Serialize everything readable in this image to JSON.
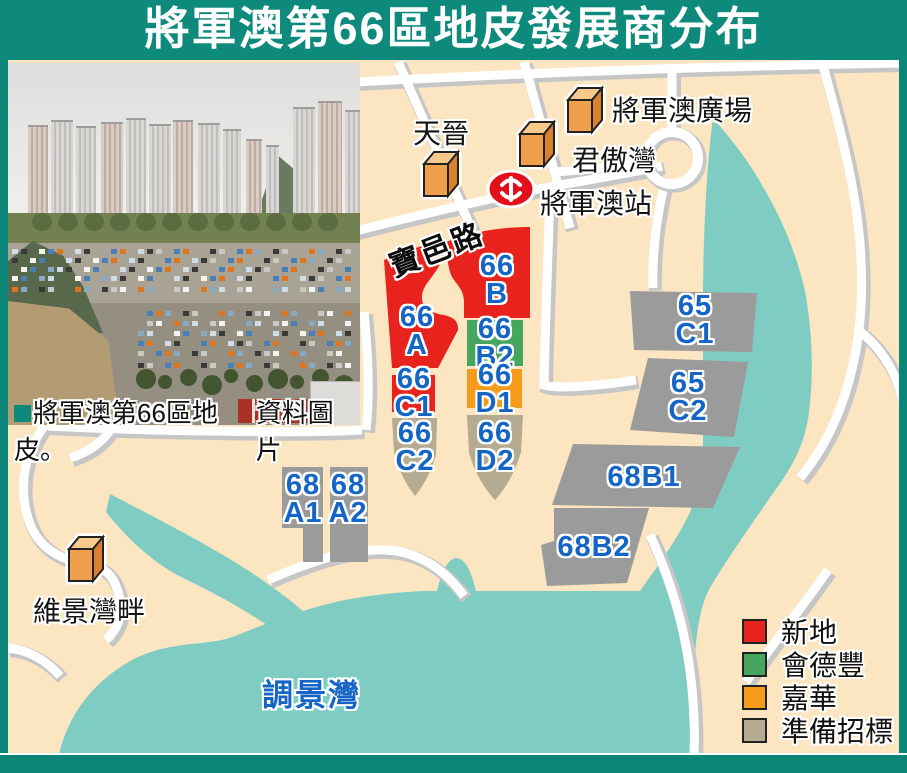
{
  "title": "將軍澳第66區地皮發展商分布",
  "photo": {
    "caption": "將軍澳第66區地皮。",
    "credit": "資料圖片"
  },
  "map": {
    "road_label": "寶邑路",
    "water_label": "調景灣",
    "station": {
      "label": "將軍澳站",
      "icon": "mtr-logo"
    },
    "places": [
      {
        "label": "天晉"
      },
      {
        "label": "君傲灣"
      },
      {
        "label": "將軍澳廣場"
      },
      {
        "label": "維景灣畔"
      }
    ],
    "plots": [
      {
        "id": "66A",
        "label": "66\nA",
        "color": "#e8221c",
        "developer": "新地"
      },
      {
        "id": "66B",
        "label": "66\nB",
        "color": "#e8221c",
        "developer": "新地"
      },
      {
        "id": "66B2",
        "label": "66\nB2",
        "color": "#46a55f",
        "developer": "會德豐"
      },
      {
        "id": "66D1",
        "label": "66\nD1",
        "color": "#f59c1d",
        "developer": "嘉華"
      },
      {
        "id": "66C1",
        "label": "66\nC1",
        "color": "#e8221c",
        "developer": "新地"
      },
      {
        "id": "66C2",
        "label": "66\nC2",
        "color": "#b5ab90",
        "developer": "準備招標"
      },
      {
        "id": "66D2",
        "label": "66\nD2",
        "color": "#b5ab90",
        "developer": "準備招標"
      },
      {
        "id": "65C1",
        "label": "65\nC1",
        "color": "#9b9b9b"
      },
      {
        "id": "65C2",
        "label": "65\nC2",
        "color": "#9b9b9b"
      },
      {
        "id": "68A1",
        "label": "68\nA1",
        "color": "#9b9b9b"
      },
      {
        "id": "68A2",
        "label": "68\nA2",
        "color": "#9b9b9b"
      },
      {
        "id": "68B1",
        "label": "68B1",
        "color": "#9b9b9b"
      },
      {
        "id": "68B2",
        "label": "68B2",
        "color": "#9b9b9b"
      }
    ]
  },
  "legend": {
    "items": [
      {
        "label": "新地",
        "color": "#e8221c"
      },
      {
        "label": "會德豐",
        "color": "#46a55f"
      },
      {
        "label": "嘉華",
        "color": "#f59c1d"
      },
      {
        "label": "準備招標",
        "color": "#b5ab90"
      }
    ]
  },
  "colors": {
    "title_bar": "#0e8a7c",
    "frame": "#0c8579",
    "land": "#fce5c1",
    "water": "#7fccc2",
    "plot_label_blue": "#1565c6",
    "mtr_red": "#e3101b",
    "cube_front": "#efa04c",
    "cube_top": "#f7c98a",
    "cube_side": "#d9812f"
  }
}
